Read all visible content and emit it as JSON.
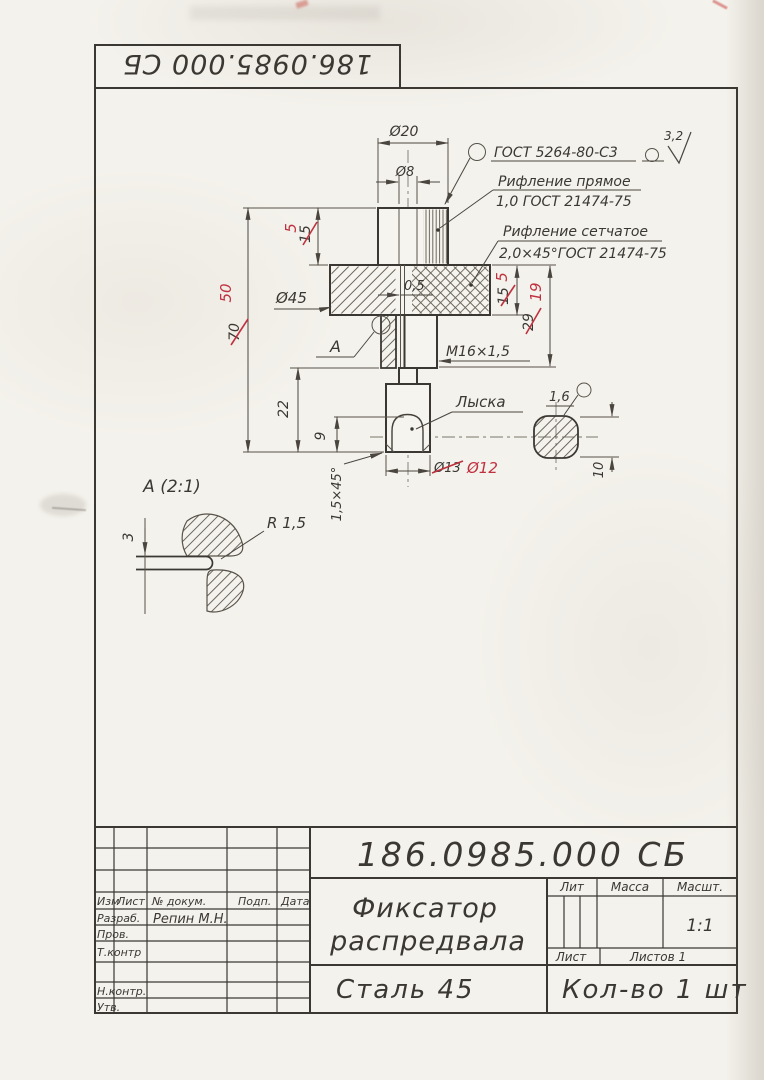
{
  "stamp": {
    "number": "186.0985.000 СБ"
  },
  "drawing": {
    "labels": {
      "weld": "ГОСТ 5264-80-С3",
      "rough": "3,2",
      "knurl1a": "Рифление прямое",
      "knurl1b": "1,0 ГОСТ 21474-75",
      "knurl2a": "Рифление сетчатое",
      "knurl2b": "2,0×45°ГОСТ 21474-75",
      "thread": "М16×1,5",
      "flat": "Лыска",
      "detail_ref": "А",
      "detail_title": "А (2:1)",
      "radius": "R 1,5"
    },
    "dims": {
      "d20": "Ø20",
      "d8": "Ø8",
      "d45": "Ø45",
      "gap": "0,5",
      "h70_old": "70",
      "h70_new": "50",
      "h15_old": "15",
      "h15_new": "5",
      "r15_old": "15",
      "r15_new": "5",
      "r29_old": "29",
      "r29_new": "19",
      "h22": "22",
      "h9": "9",
      "chamfer": "1,5×45°",
      "d13_old": "Ø13",
      "d13_new": "Ø12",
      "flat_w": "1,6",
      "w10": "10",
      "det3": "3"
    }
  },
  "title_block": {
    "doc_number": "186.0985.000 СБ",
    "name1": "Фиксатор",
    "name2": "распредвала",
    "material": "Сталь 45",
    "quantity": "Кол-во 1 шт",
    "lit": "Лит",
    "mass": "Масса",
    "scale_lbl": "Масшт.",
    "scale": "1:1",
    "sheet": "Лист",
    "sheets": "Листов 1",
    "col_izm": "Изм",
    "col_list": "Лист",
    "col_doc": "№ докум.",
    "col_sign": "Подп.",
    "col_date": "Дата",
    "razrab": "Разраб.",
    "razrab_name": "Репин М.Н.",
    "prov": "Пров.",
    "tkontr": "Т.контр",
    "nkontr": "Н.контр.",
    "utv": "Утв."
  },
  "colors": {
    "ink": "#3b3833",
    "red": "#c0313f",
    "paper": "#f4f2ec"
  }
}
